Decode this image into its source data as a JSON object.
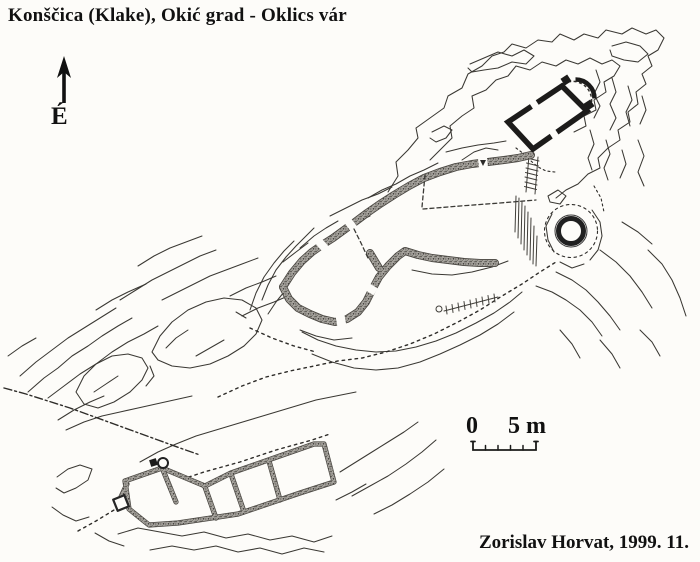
{
  "title": "Konščica (Klake), Okić grad - Oklics vár",
  "north_indicator": {
    "label": "É",
    "icon": "north-arrow"
  },
  "scale_bar": {
    "zero_label": "0",
    "five_label": "5 m",
    "units": "m",
    "segments": 5
  },
  "credit": "Zorislav Horvat, 1999. 11.",
  "palette": {
    "paper": "#fdfcf9",
    "ink": "#35332f",
    "wall_black": "#1c1b1a",
    "wall_stipple_base": "#a9a6a0",
    "wall_stipple_dot": "#49463f"
  },
  "plan_features": [
    "terrain-contour-lines",
    "upper-castle-chapel-with-apse",
    "main-enclosure-curtain-wall",
    "round-tower",
    "rock-scarp-hachure",
    "outer-ward-building",
    "gate-structure",
    "dashed-path-trails",
    "rock-outcrops"
  ]
}
